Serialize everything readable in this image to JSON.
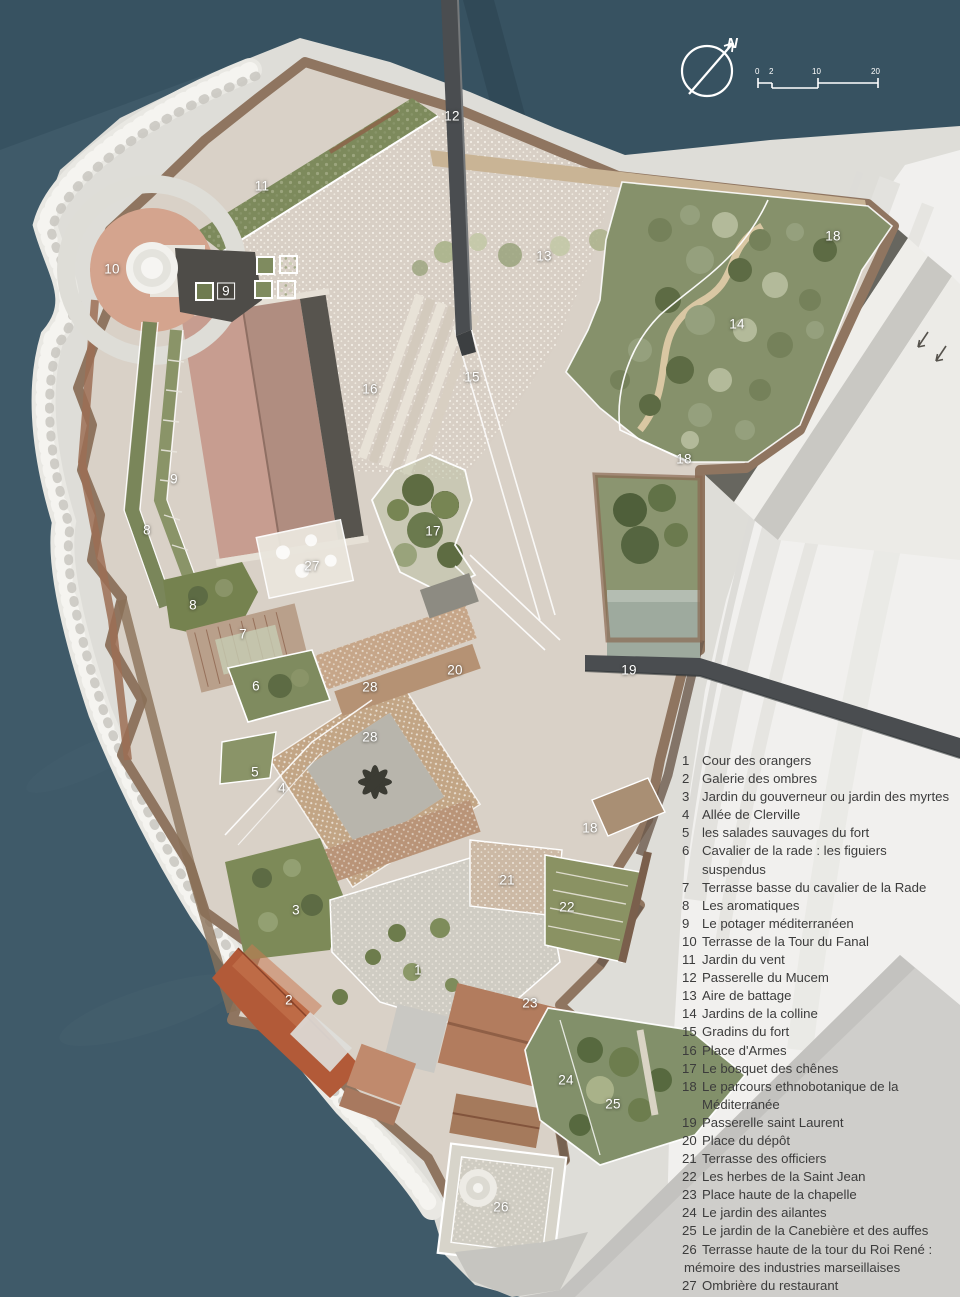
{
  "compass": {
    "north": "N",
    "scale": {
      "t0": "0",
      "t1": "2",
      "t2": "10",
      "t3": "20"
    }
  },
  "legend": {
    "items": [
      {
        "n": "1",
        "t": "Cour des orangers"
      },
      {
        "n": "2",
        "t": "Galerie des ombres"
      },
      {
        "n": "3",
        "t": "Jardin du gouverneur ou jardin des myrtes"
      },
      {
        "n": "4",
        "t": "Allée de Clerville"
      },
      {
        "n": "5",
        "t": "les salades sauvages du fort"
      },
      {
        "n": "6",
        "t": "Cavalier de la rade : les figuiers suspendus"
      },
      {
        "n": "7",
        "t": "Terrasse basse du cavalier de la Rade"
      },
      {
        "n": "8",
        "t": "Les aromatiques"
      },
      {
        "n": "9",
        "t": "Le potager méditerranéen"
      },
      {
        "n": "10",
        "t": "Terrasse de la Tour du Fanal"
      },
      {
        "n": "11",
        "t": "Jardin du vent"
      },
      {
        "n": "12",
        "t": "Passerelle du Mucem"
      },
      {
        "n": "13",
        "t": "Aire de battage"
      },
      {
        "n": "14",
        "t": "Jardins de la colline"
      },
      {
        "n": "15",
        "t": "Gradins du fort"
      },
      {
        "n": "16",
        "t": "Place d'Armes"
      },
      {
        "n": "17",
        "t": "Le bosquet des chênes"
      },
      {
        "n": "18",
        "t": "Le parcours ethnobotanique de la Méditerranée"
      },
      {
        "n": "19",
        "t": "Passerelle saint Laurent"
      },
      {
        "n": "20",
        "t": "Place du dépôt"
      },
      {
        "n": "21",
        "t": "Terrasse des officiers"
      },
      {
        "n": "22",
        "t": "Les herbes de la Saint Jean"
      },
      {
        "n": "23",
        "t": "Place haute de la chapelle"
      },
      {
        "n": "24",
        "t": "Le jardin des ailantes"
      },
      {
        "n": "25",
        "t": "Le jardin de la Canebière et des auffes"
      },
      {
        "n": "26",
        "t": "Terrasse haute de la tour du Roi René :",
        "t2": "mémoire des industries marseillaises"
      },
      {
        "n": "27",
        "t": "Ombrière du restaurant"
      },
      {
        "n": "28",
        "t": "Allée du village"
      }
    ]
  },
  "map_labels": [
    {
      "t": "12",
      "x": 452,
      "y": 116
    },
    {
      "t": "11",
      "x": 262,
      "y": 186
    },
    {
      "t": "10",
      "x": 112,
      "y": 269
    },
    {
      "t": "9",
      "x": 226,
      "y": 291,
      "boxed": true
    },
    {
      "t": "13",
      "x": 544,
      "y": 256
    },
    {
      "t": "18",
      "x": 833,
      "y": 236
    },
    {
      "t": "14",
      "x": 737,
      "y": 324
    },
    {
      "t": "15",
      "x": 472,
      "y": 377
    },
    {
      "t": "16",
      "x": 370,
      "y": 389
    },
    {
      "t": "18",
      "x": 684,
      "y": 459
    },
    {
      "t": "9",
      "x": 174,
      "y": 479
    },
    {
      "t": "8",
      "x": 147,
      "y": 530
    },
    {
      "t": "17",
      "x": 433,
      "y": 531
    },
    {
      "t": "27",
      "x": 312,
      "y": 566
    },
    {
      "t": "8",
      "x": 193,
      "y": 605
    },
    {
      "t": "7",
      "x": 243,
      "y": 634
    },
    {
      "t": "20",
      "x": 455,
      "y": 670
    },
    {
      "t": "19",
      "x": 629,
      "y": 670
    },
    {
      "t": "6",
      "x": 256,
      "y": 686
    },
    {
      "t": "28",
      "x": 370,
      "y": 687
    },
    {
      "t": "28",
      "x": 370,
      "y": 737
    },
    {
      "t": "5",
      "x": 255,
      "y": 772
    },
    {
      "t": "4",
      "x": 282,
      "y": 788
    },
    {
      "t": "18",
      "x": 590,
      "y": 828
    },
    {
      "t": "21",
      "x": 507,
      "y": 880
    },
    {
      "t": "22",
      "x": 567,
      "y": 907
    },
    {
      "t": "3",
      "x": 296,
      "y": 910
    },
    {
      "t": "1",
      "x": 418,
      "y": 970
    },
    {
      "t": "2",
      "x": 289,
      "y": 1000
    },
    {
      "t": "23",
      "x": 530,
      "y": 1003
    },
    {
      "t": "24",
      "x": 566,
      "y": 1080
    },
    {
      "t": "25",
      "x": 613,
      "y": 1104
    },
    {
      "t": "26",
      "x": 501,
      "y": 1207
    }
  ],
  "colors": {
    "water": "#3f5a69",
    "water_deep": "#36505f",
    "land": "#deddd8",
    "esplanade": "#f1f0ee",
    "cobble": "#d8cfc5",
    "green": "#86916b",
    "green_dark": "#5f6d44",
    "rampart": "#8d7360",
    "russet": "#9c6e55",
    "roof_pink": "#c79d90",
    "roof_red": "#b25a38",
    "roof_tile": "#b27c5e",
    "passerelle": "#4a4d50",
    "sage": "#9eaa9e",
    "label": "#ffffff",
    "legend_text": "#3c3c3c"
  }
}
